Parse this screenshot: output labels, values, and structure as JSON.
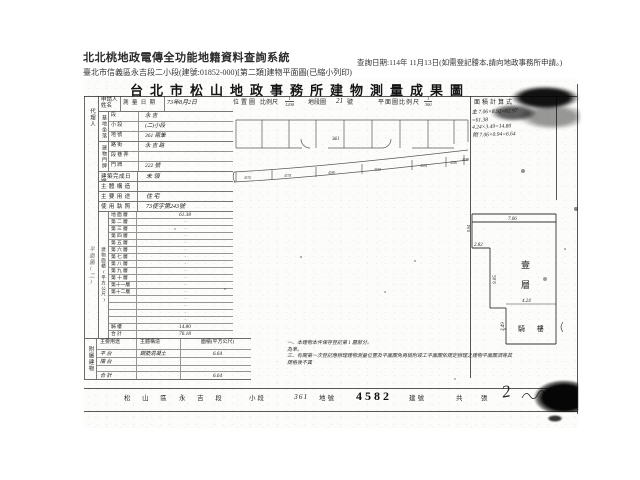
{
  "header": {
    "system_title": "北北桃地政電傳全功能地籍資料查詢系統",
    "subtitle": "臺北市信義區永吉段二小段(建號:01852-000)[第二類]建物平面圖(已縮小列印)",
    "query_date": "查詢日期:114年 11月13日(如需登記謄本,請向地政事務所申請。)"
  },
  "doc": {
    "title": "台北市松山地政事務所建物測量成果圖",
    "agent_label": "代理人",
    "side_note": "平面圖(二)",
    "form": {
      "applicant_label": "申請人姓名",
      "survey_label": "測 量 日 期",
      "survey_value": "73年8月2日",
      "site_label": "基地坐落",
      "site_rows": [
        {
          "l": "段",
          "v": "永 吉"
        },
        {
          "l": "小 段",
          "v": "(二)小段"
        },
        {
          "l": "地 號",
          "v": "361 兩筆"
        }
      ],
      "addr_label": "建物門牌",
      "addr_rows": [
        {
          "l": "路 街",
          "v": "永 吉 路"
        },
        {
          "l": "段 巷 弄",
          "v": ""
        },
        {
          "l": "門 牌",
          "v": "222 號"
        }
      ],
      "info_rows": [
        {
          "l": "建築完成日期",
          "v": "未 領"
        },
        {
          "l": "主 體 構 造",
          "v": ""
        },
        {
          "l": "主 要 用 途",
          "v": "住 宅"
        },
        {
          "l": "使 用 執 照",
          "v": "73使字第243號"
        }
      ],
      "area_label": "建物面積(平方公尺)",
      "floor_rows": [
        {
          "l": "地 面 層",
          "v": "61.38"
        },
        {
          "l": "第 二 層",
          "v": "·"
        },
        {
          "l": "第 三 層",
          "v": "·"
        },
        {
          "l": "第 四 層",
          "v": "·"
        },
        {
          "l": "第 五 層",
          "v": "·"
        },
        {
          "l": "第 六 層",
          "v": "·"
        },
        {
          "l": "第 七 層",
          "v": "·"
        },
        {
          "l": "第 八 層",
          "v": "·"
        },
        {
          "l": "第 九 層",
          "v": "·"
        },
        {
          "l": "第 十 層",
          "v": "·"
        },
        {
          "l": "第十一層",
          "v": "·"
        },
        {
          "l": "第十二層",
          "v": "·"
        },
        {
          "l": "",
          "v": "·"
        },
        {
          "l": "",
          "v": "·"
        },
        {
          "l": "",
          "v": "·"
        },
        {
          "l": "",
          "v": "·"
        },
        {
          "l": "騎  樓",
          "v": "14.80"
        },
        {
          "l": "合  計",
          "v": "76.18"
        }
      ]
    },
    "annex": {
      "label": "附屬建物",
      "headers": {
        "use": "主要用途",
        "structure": "主體構造",
        "area": "面積(平方公尺)"
      },
      "rows": [
        {
          "u": "平 台",
          "s": "鋼筋混凝土",
          "a": "6.64"
        },
        {
          "u": "陽 台",
          "s": "",
          "a": ""
        },
        {
          "u": "",
          "s": "",
          "a": ""
        },
        {
          "u": "合 計",
          "s": "",
          "a": "6.64"
        }
      ]
    },
    "map_header": {
      "location": "位置圖",
      "scale_label": "比例尺",
      "scale_num": "1",
      "scale_den": "1200",
      "sheet_label": "地段圖",
      "sheet_no": "21",
      "sheet_unit": "號",
      "plan_scale_label": "平面圖比例尺",
      "plan_num": "1",
      "plan_den": "300",
      "calc_label": "面積計算式"
    },
    "map": {
      "parcel_no": "361",
      "building_nos": [
        "4576",
        "4578",
        "4580",
        "4582",
        "4584",
        "4586",
        "4588"
      ]
    },
    "calc_lines": [
      {
        "t": "主 7.06×8.92=62.97"
      },
      {
        "t": "=61.38"
      },
      {
        "t": "4.24×3.49=14.80"
      },
      {
        "t": "附 7.06×0.94=6.64"
      }
    ],
    "plan": {
      "floor_label_1": "壹",
      "floor_label_2": "層",
      "arcade_label": "騎 樓",
      "dim_top": "7.06",
      "dim_notch": "0.94",
      "dim_step": "2.82",
      "dim_height": "9.05",
      "dim_arcade_w": "4.24",
      "dim_arcade_h": "3.49"
    },
    "notes": [
      {
        "t": "一、本建物本件保存登記第 1 層部分。"
      },
      {
        "t": "為準。"
      },
      {
        "t": "三、有關第一次登記應辦理建物測量位置及平面圖免再檢附竣工平面圖依規定辦理之建物平面圖須等其"
      },
      {
        "t": "規格後不異"
      }
    ],
    "footer": {
      "district": "松 山 區",
      "section": "永 吉 段",
      "subsection_label": "小段",
      "parcel": "361",
      "parcel_label": "地號",
      "building_no": "4582",
      "building_label": "建號",
      "count_label": "共　張",
      "count_value": "2"
    }
  }
}
